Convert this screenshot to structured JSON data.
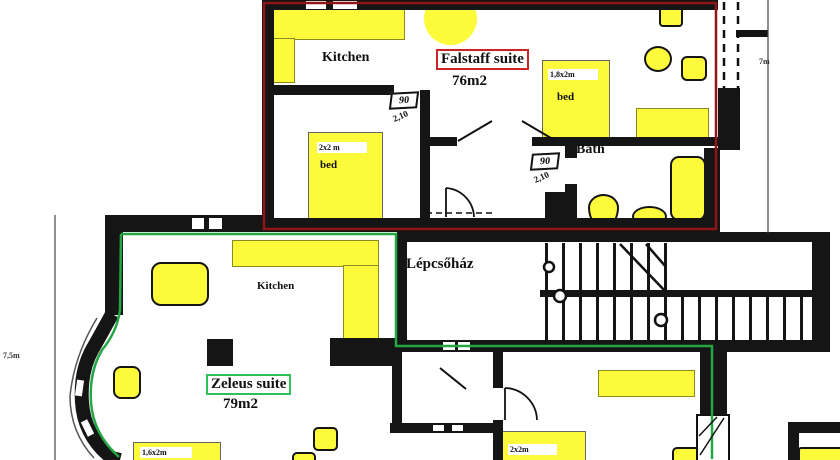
{
  "falstaff": {
    "title": "Falstaff suite",
    "area": "76m2",
    "kitchen_label": "Kitchen",
    "bath_label": "Bath",
    "bed_large": {
      "size": "1,8x2m",
      "label": "bed"
    },
    "bed_small": {
      "size": "2x2 m",
      "label": "bed"
    }
  },
  "zeleus": {
    "title": "Zeleus suite",
    "area": "79m2",
    "kitchen_label": "Kitchen",
    "bed_left": {
      "size": "1,6x2m"
    },
    "bed_right": {
      "size": "2x2m"
    }
  },
  "stairwell": {
    "label": "Lépcsőház"
  },
  "doors": [
    {
      "width": "90",
      "height": "2,10"
    },
    {
      "width": "90",
      "height": "2,10"
    }
  ],
  "dimensions": {
    "right": "7m",
    "left": "7,5m"
  },
  "colors": {
    "furniture_yellow": "#fcfa3a",
    "wall_black": "#151515",
    "falstaff_outline_red": "#8e1616",
    "falstaff_box_red": "#cc2424",
    "zeleus_outline_green": "#23a643",
    "zeleus_box_green": "#2fbf57"
  }
}
